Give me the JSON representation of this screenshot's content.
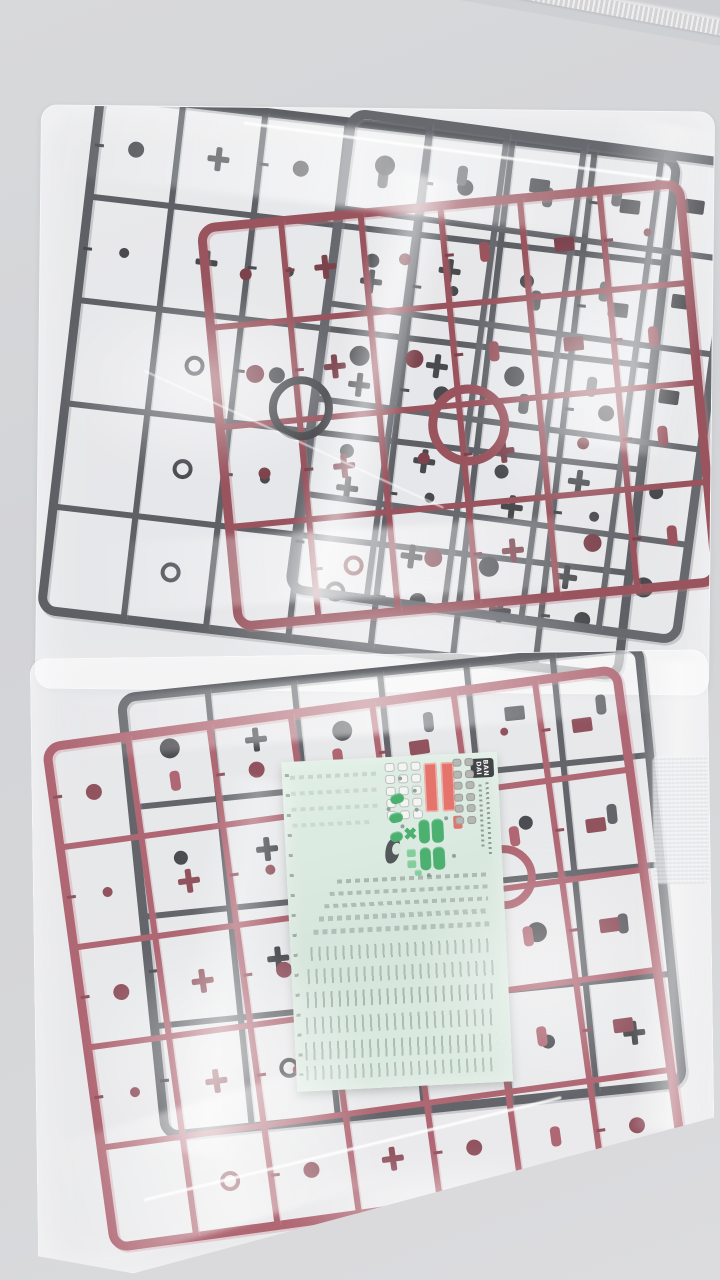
{
  "scene": {
    "type": "photograph",
    "subject": "Two sealed clear plastic bags of injection-molded model kit sprues on a light grey surface; the lower bag also holds a mint-green marking sticker sheet",
    "wall_color": "#d6d7da",
    "bag_film_highlight": "#f5f6f8"
  },
  "top_bag": {
    "label": "upper sprue bag",
    "grey_sprue_color": "#3f4147",
    "grey_sprue_color_2": "#4a4c53",
    "grey_sprue_dark": "#26272c",
    "grey_sprue_light": "#70727a",
    "red_sprue_color": "#86333f",
    "red_sprue_dark": "#631f2b",
    "red_sprue_light": "#a8606c"
  },
  "bottom_bag": {
    "label": "lower sprue bag",
    "grey_sprue_color": "#45474d",
    "grey_sprue_dark": "#2a2b30",
    "grey_sprue_light": "#74767e",
    "red_sprue_color": "#a04a58",
    "red_sprue_dark": "#7c3340",
    "red_sprue_light": "#c27a87"
  },
  "decal_sheet": {
    "label": "marking sticker sheet",
    "sheet_color": "#d6e8dd",
    "brand_logo": {
      "line1": "BAN",
      "line2": "DAI",
      "bg": "#1e2023",
      "fg": "#f2f3f1"
    },
    "decal_colors": {
      "red": "#e15b50",
      "green": "#2aa255",
      "green_light": "#6cc68a",
      "grey": "#a9a9a4",
      "white": "#f3f5f2",
      "black": "#34383a",
      "mark": "#7b918a"
    }
  }
}
